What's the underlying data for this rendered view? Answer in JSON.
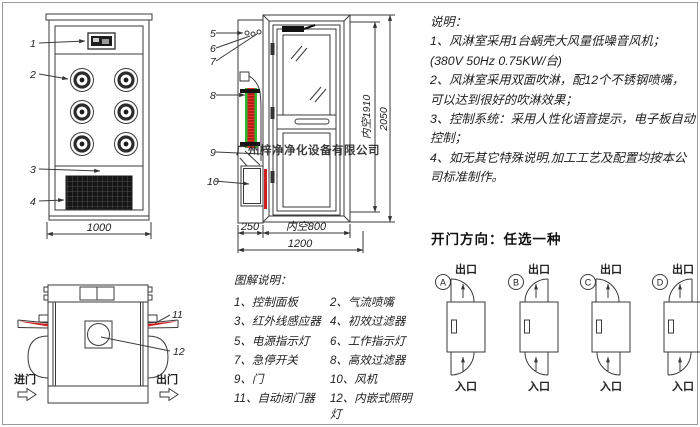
{
  "colors": {
    "line": "#3a3a3a",
    "red": "#d92b20",
    "green": "#2eb82e",
    "dark": "#141414"
  },
  "watermark": "广州梓净净化设备有限公司",
  "front_view": {
    "part_labels": [
      "1",
      "2",
      "3",
      "4"
    ],
    "width_dim": "1000"
  },
  "side_view": {
    "part_labels": [
      "5",
      "6",
      "7",
      "8",
      "9",
      "10"
    ],
    "dims": {
      "left_section": "250",
      "inner_width": "内空800",
      "total_width": "1200",
      "inner_height": "内空1910",
      "total_height": "2050"
    }
  },
  "top_view": {
    "part_labels": [
      "11",
      "12"
    ],
    "entry_label": "进门",
    "exit_label": "出门"
  },
  "notes": {
    "title": "说明：",
    "lines": [
      "1、风淋室采用1台蜗壳大风量低噪音风机；",
      "(380V  50Hz  0.75KW/台)",
      "2、风淋室采用双面吹淋，配12个不锈钢喷嘴，",
      "可以达到很好的吹淋效果；",
      "3、控制系统：采用人性化语音提示，电子板自动控制；",
      "4、如无其它特殊说明,加工工艺及配置均按本公司标准制作。"
    ]
  },
  "legend": {
    "title": "图解说明：",
    "items": [
      "1、控制面板",
      "2、气流喷嘴",
      "3、红外线感应器",
      "4、初效过滤器",
      "5、电源指示灯",
      "6、工作指示灯",
      "7、急停开关",
      "8、高效过滤器",
      "9、门",
      "10、风机",
      "11、自动闭门器",
      "12、内嵌式照明灯"
    ]
  },
  "door_options": {
    "title": "开门方向：任选一种",
    "exit_label": "出口",
    "entry_label": "入口",
    "options": [
      {
        "letter": "A"
      },
      {
        "letter": "B"
      },
      {
        "letter": "C"
      },
      {
        "letter": "D"
      }
    ]
  }
}
